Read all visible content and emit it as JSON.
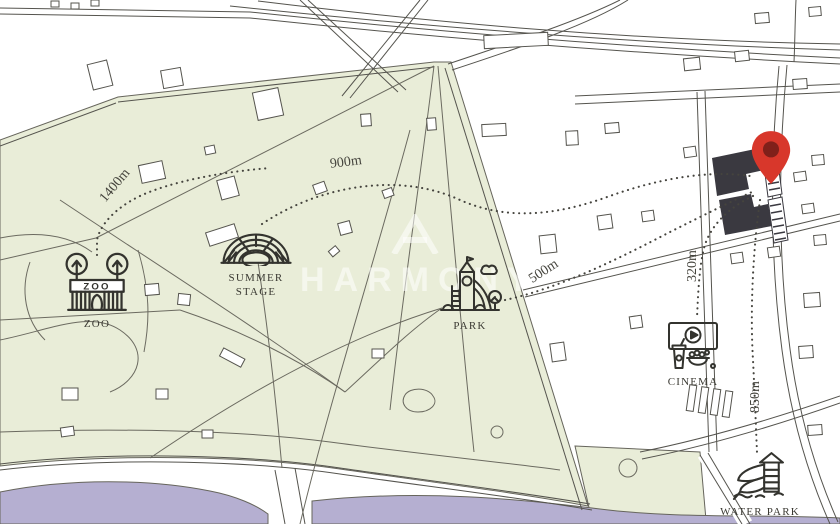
{
  "colors": {
    "park_green": "#e9edd8",
    "water_purple": "#b5afd1",
    "line": "#55544e",
    "building_dark": "#3a3940",
    "pin_red": "#d8372b",
    "pin_hole": "#80201a",
    "icon_stroke": "#33332e",
    "label_text": "#3b3a33"
  },
  "watermark": {
    "brand": "HARMONY"
  },
  "pois": [
    {
      "id": "zoo",
      "label": "ZOO",
      "sign_text": "ZOO"
    },
    {
      "id": "summer-stage",
      "label_line1": "SUMMER",
      "label_line2": "STAGE"
    },
    {
      "id": "park",
      "label": "PARK"
    },
    {
      "id": "cinema",
      "label": "CINEMA"
    },
    {
      "id": "water-park",
      "label": "WATER PARK"
    }
  ],
  "distances": [
    {
      "id": "1400",
      "label": "1400m"
    },
    {
      "id": "900",
      "label": "900m"
    },
    {
      "id": "500",
      "label": "500m"
    },
    {
      "id": "320",
      "label": "320m"
    },
    {
      "id": "850",
      "label": "850m"
    }
  ]
}
